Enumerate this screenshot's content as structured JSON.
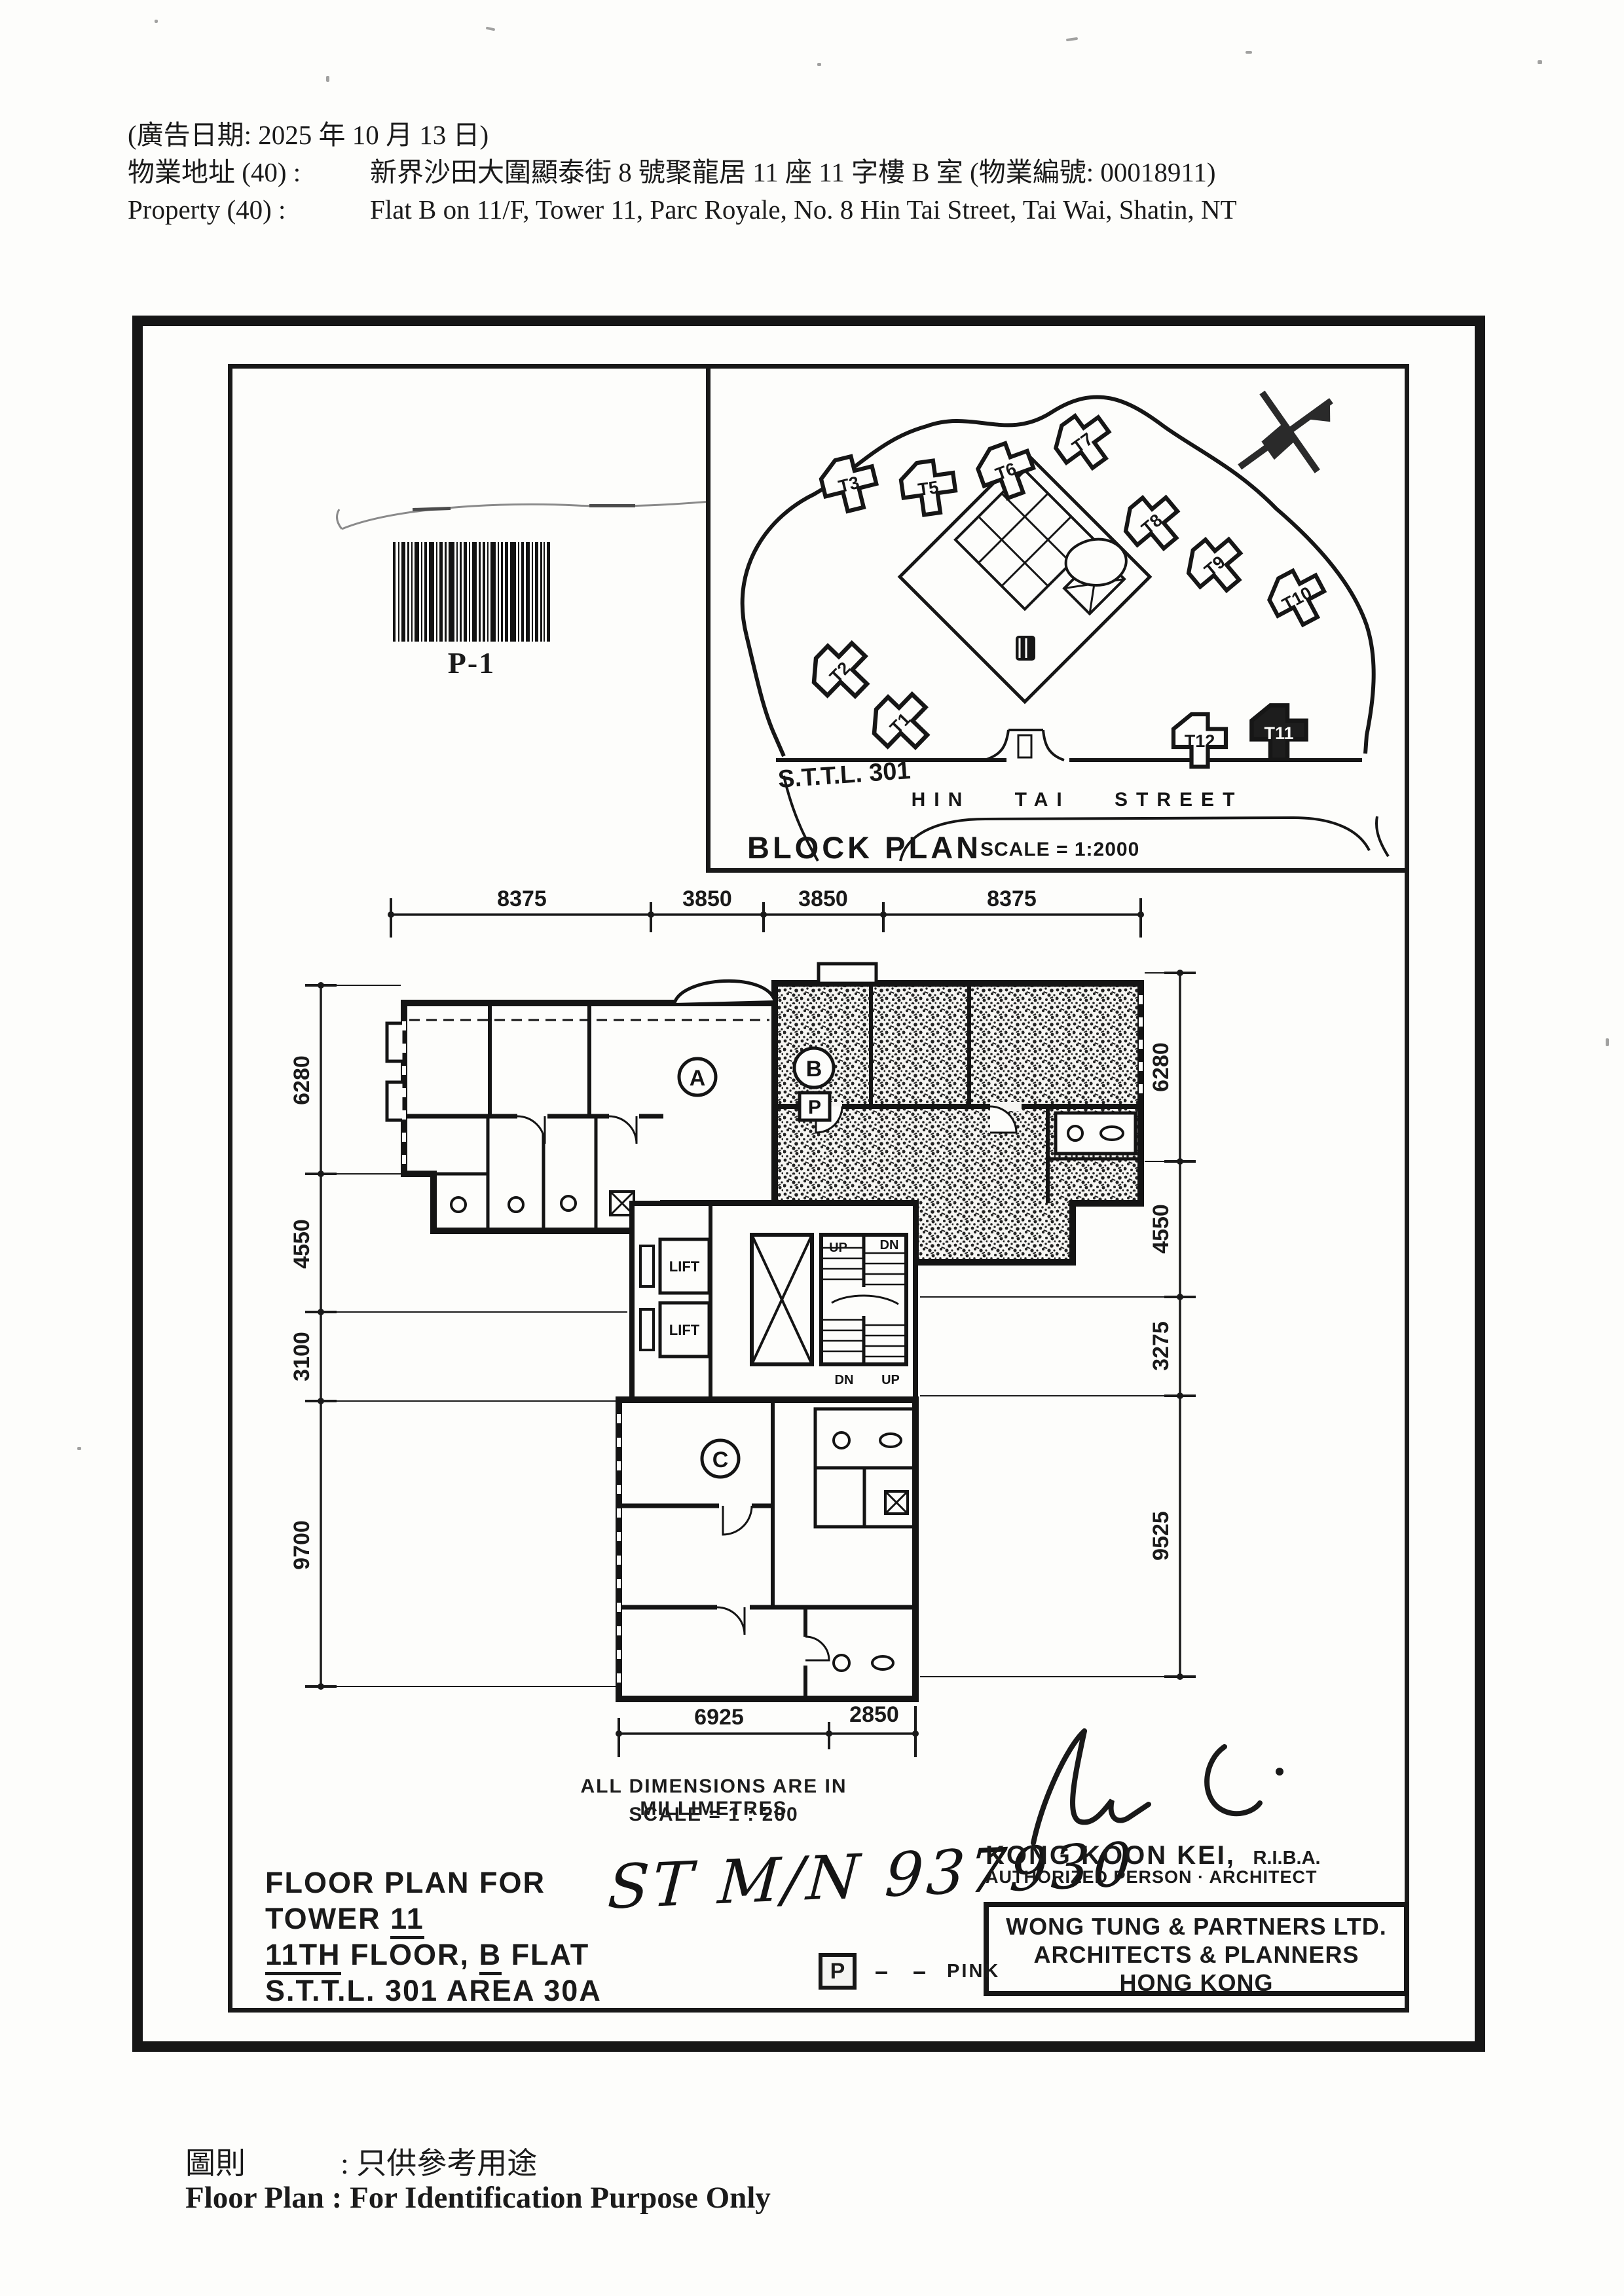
{
  "header": {
    "line1": "(廣告日期:  2025 年 10 月 13 日)",
    "label_zh": "物業地址 (40) :",
    "value_zh": "新界沙田大圍顯泰街 8 號聚龍居 11 座 11 字樓 B 室 (物業編號: 00018911)",
    "label_en": "Property   (40) :",
    "value_en": "Flat B on 11/F, Tower 11, Parc Royale, No. 8 Hin Tai Street, Tai Wai, Shatin, NT"
  },
  "barcode": {
    "label": "P-1"
  },
  "block_plan": {
    "title": "BLOCK PLAN",
    "scale": "SCALE = 1:2000",
    "lot": "S.T.T.L. 301",
    "street": "HIN TAI STREET",
    "towers": {
      "t1": "T1",
      "t2": "T2",
      "t3": "T3",
      "t5": "T5",
      "t6": "T6",
      "t7": "T7",
      "t8": "T8",
      "t9": "T9",
      "t10": "T10",
      "t11": "T11",
      "t12": "T12"
    },
    "highlighted_tower": "T11"
  },
  "floor_plan": {
    "dims_top": [
      "8375",
      "3850",
      "3850",
      "8375"
    ],
    "dims_left": [
      "6280",
      "4550",
      "3100",
      "9700"
    ],
    "dims_right": [
      "6280",
      "4550",
      "3275",
      "9525"
    ],
    "dims_bottom": [
      "6925",
      "2850"
    ],
    "flat_a": "A",
    "flat_b": "B",
    "flat_c": "C",
    "pink_box": "P",
    "lift": "LIFT",
    "stairs": {
      "up_top": "UP",
      "dn_top": "DN",
      "dn_bottom": "DN",
      "up_bottom": "UP"
    }
  },
  "notes": {
    "dims_note": "ALL DIMENSIONS ARE IN MILLIMETRES",
    "scale_note": "SCALE  =  1 : 200",
    "handwritten": "ST M/N 937930",
    "architect_name": "KONG KOON KEI,",
    "architect_qual": "R.I.B.A.",
    "architect_role": "AUTHORIZED PERSON · ARCHITECT",
    "firm_line1": "WONG TUNG & PARTNERS LTD.",
    "firm_line2": "ARCHITECTS & PLANNERS",
    "firm_line3": "HONG KONG",
    "legend_p": "P",
    "legend_dashes": "– –",
    "legend_pink": "PINK"
  },
  "title_block": {
    "line1": "FLOOR PLAN FOR",
    "line2_pre": "TOWER ",
    "line2_u": "11",
    "line3_u1": "11TH",
    "line3_mid": " FLOOR, ",
    "line3_u2": "B",
    "line3_post": " FLAT",
    "line4": "S.T.T.L. 301  AREA 30A"
  },
  "footer": {
    "zh_label": "圖則",
    "zh_value": ":  只供參考用途",
    "en": "Floor Plan : For Identification Purpose Only"
  }
}
